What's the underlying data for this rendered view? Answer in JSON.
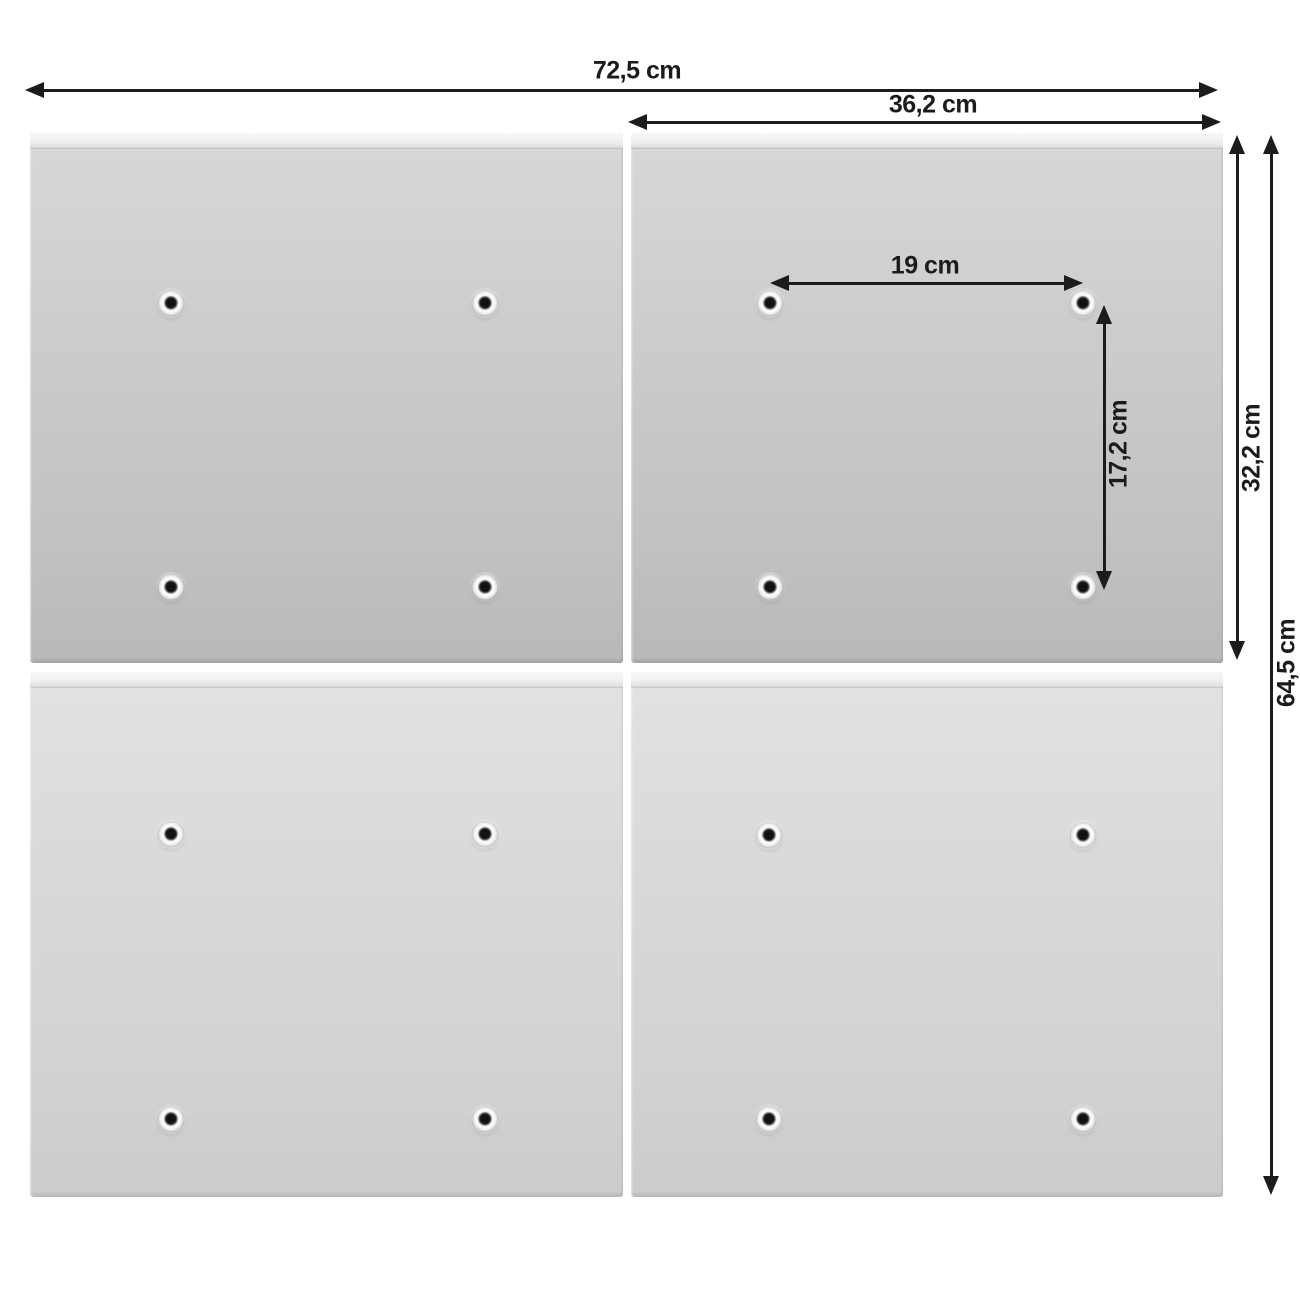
{
  "diagram": {
    "type": "product-dimension-diagram",
    "unit": "cm",
    "grid": {
      "rows": 2,
      "columns": 2,
      "holes_per_panel": 4
    },
    "labels": {
      "total_width": "72,5 cm",
      "panel_width": "36,2 cm",
      "hole_spacing_width": "19 cm",
      "hole_spacing_height": "17,2 cm",
      "panel_height": "32,2 cm",
      "total_height": "64,5 cm"
    },
    "colors": {
      "background": "#ffffff",
      "dimension_lines": "#1c1c1c",
      "panel_face_top_row": "#c6c6c6",
      "panel_face_bottom_row": "#d6d6d6",
      "panel_edge_strip": "#f2f2f2",
      "hole_dot": "#121212"
    }
  }
}
